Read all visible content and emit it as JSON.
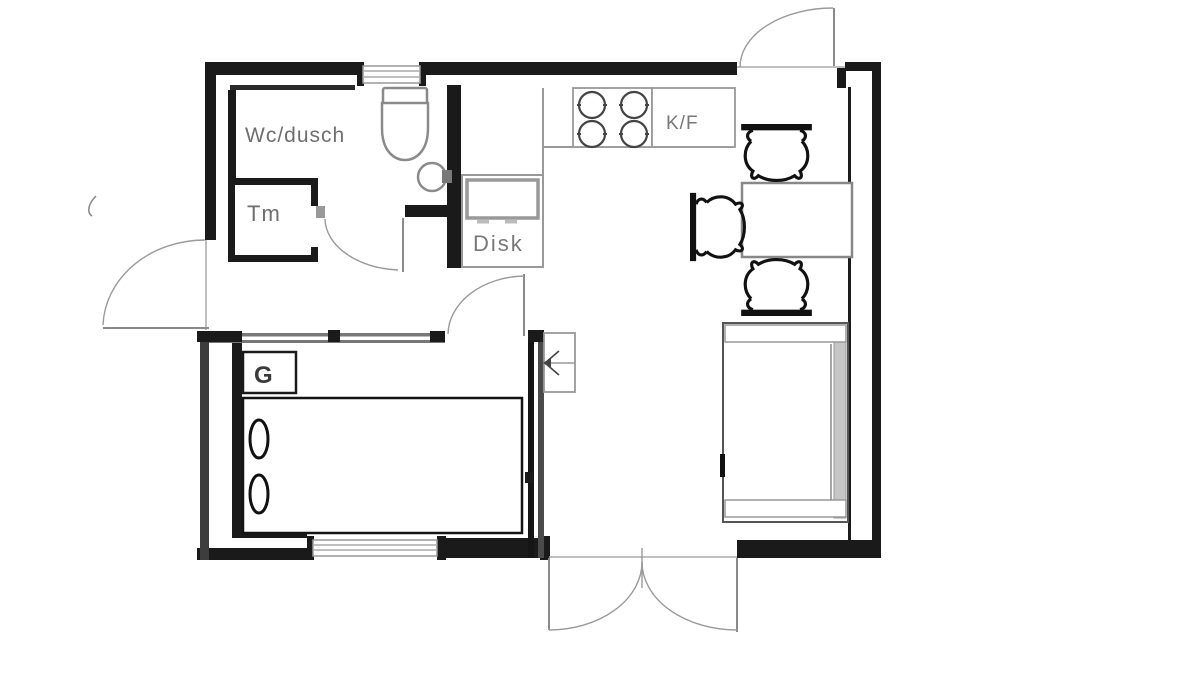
{
  "floorplan": {
    "labels": {
      "bathroom": "Wc/dusch",
      "laundry_cabinet": "Tm",
      "dishwasher_sink": "Disk",
      "fridge_freezer": "K/F",
      "wardrobe": "G"
    },
    "colors": {
      "wall": "#1a1a1a",
      "secondary_line": "#999999",
      "fixture_outline": "#8a8a8a",
      "label_text": "#6e6e6e",
      "background": "#ffffff"
    }
  }
}
